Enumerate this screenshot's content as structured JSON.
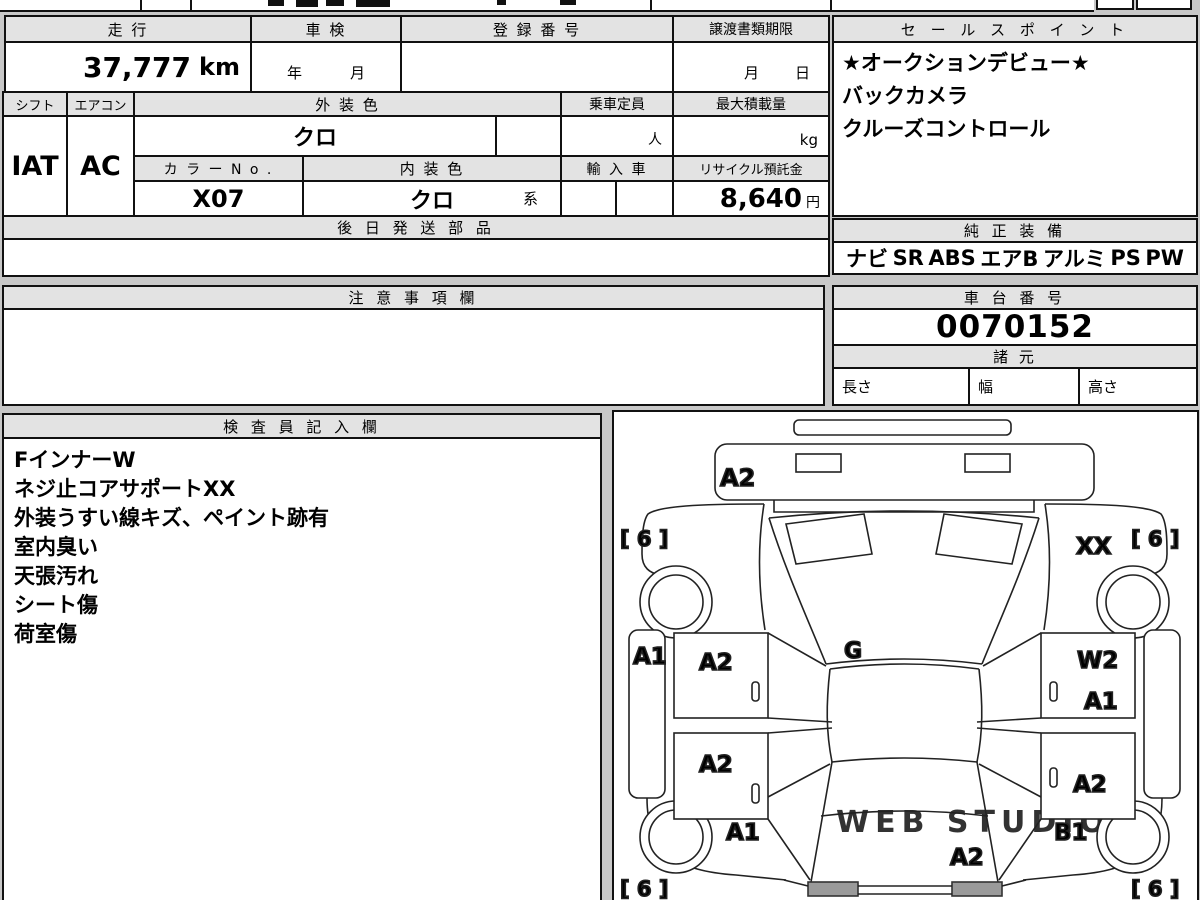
{
  "colors": {
    "page_bg": "#c8c8c8",
    "cell_bg": "#ffffff",
    "header_bg": "#e3e3e3",
    "border": "#111111",
    "tail_light_fill": "#9a9a9a",
    "watermark": "#cccccc"
  },
  "top_table": {
    "mileage_label": "走 行",
    "mileage_value": "37,777",
    "mileage_unit": "km",
    "inspection_label": "車 検",
    "inspection_year": "年",
    "inspection_month": "月",
    "registration_label": "登 録 番 号",
    "transfer_label": "譲渡書類期限",
    "transfer_month": "月",
    "transfer_day": "日",
    "shift_label": "シフト",
    "shift_value": "IAT",
    "aircon_label": "エアコン",
    "aircon_value": "AC",
    "exterior_label": "外 装 色",
    "exterior_value": "クロ",
    "color_no_label": "カ ラ ー N o .",
    "color_no_value": "X07",
    "interior_label": "内 装 色",
    "interior_value": "クロ",
    "interior_suffix": "系",
    "capacity_label": "乗車定員",
    "capacity_unit": "人",
    "max_load_label": "最大積載量",
    "max_load_unit": "kg",
    "import_label": "輸 入 車",
    "recycle_label": "リサイクル預託金",
    "recycle_value": "8,640",
    "recycle_unit": "円",
    "later_parts_label": "後 日 発 送 部 品"
  },
  "sales_points": {
    "title": "セ ー ル ス ポ イ ン ト",
    "items": [
      "★オークションデビュー★",
      "バックカメラ",
      "クルーズコントロール"
    ]
  },
  "genuine_equipment": {
    "title": "純 正 装 備",
    "items": [
      "ナビ",
      "SR",
      "ABS",
      "エアB",
      "アルミ",
      "PS",
      "PW"
    ]
  },
  "notes": {
    "title": "注 意 事 項 欄"
  },
  "chassis": {
    "title": "車 台 番 号",
    "value": "0070152"
  },
  "specs": {
    "title": "諸 元",
    "length_label": "長さ",
    "width_label": "幅",
    "height_label": "高さ"
  },
  "inspector": {
    "title": "検 査 員 記 入 欄",
    "lines": [
      "FインナーW",
      "ネジ止コアサポートXX",
      "外装うすい線キズ、ペイント跡有",
      "室内臭い",
      "天張汚れ",
      "シート傷",
      "荷室傷"
    ]
  },
  "diagram": {
    "front_bumper": "A2",
    "windshield": "G",
    "front_left_tire": "[ 6 ]",
    "front_right_tire": "[ 6 ]",
    "rear_left_tire": "[ 6 ]",
    "rear_right_tire": "[ 6 ]",
    "front_right_fender": "XX",
    "left_side_strip": "A1",
    "left_front_door": "A2",
    "left_rear_door": "A2",
    "right_front_door_upper": "W2",
    "right_front_door_lower": "A1",
    "right_rear_door": "A2",
    "left_rear_fender": "A1",
    "right_rear_fender": "B1",
    "rear_gate": "A2",
    "watermark": "WEB STUDIO"
  }
}
